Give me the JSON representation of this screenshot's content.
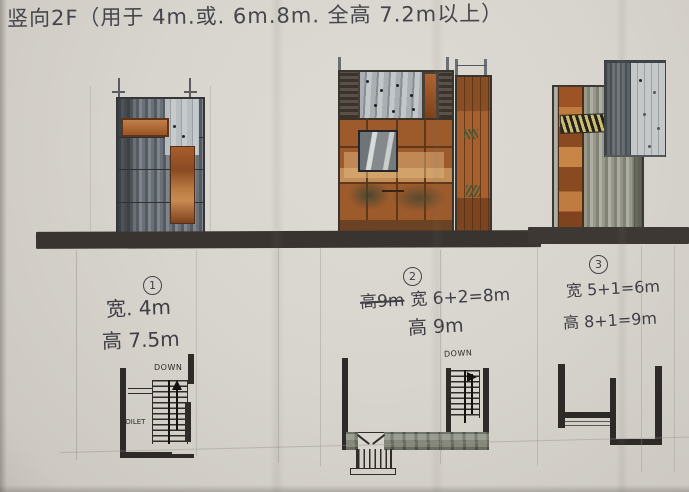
{
  "title": "竖向2F（用于 4m.或. 6m.8m. 全高 7.2m以上）",
  "annotations": {
    "a1": {
      "number": "1",
      "line1": "宽. 4m",
      "line2": "高 7.5m"
    },
    "a2": {
      "number": "2",
      "strike": "高9m",
      "line1": "宽 6+2=8m",
      "line2": "高 9m"
    },
    "a3": {
      "number": "3",
      "line1": "宽 5+1=6m",
      "line2": "高 8+1=9m"
    }
  },
  "plans": {
    "plan1": {
      "down": "DOWN",
      "toilet": "TOILET"
    },
    "plan2": {
      "down": "DOWN"
    }
  },
  "palette": {
    "paper": "#d8d4ce",
    "ink": "#3e3e44",
    "ground_band": "#393430",
    "orange_marker": "#a25b2a",
    "orange_light": "#c98a52",
    "gray_marker": "#6e757b",
    "gray_light": "#c3c7c7",
    "green_gray": "#97988a",
    "brown_line": "#5a3417",
    "wall_ink": "#2d2a27"
  }
}
